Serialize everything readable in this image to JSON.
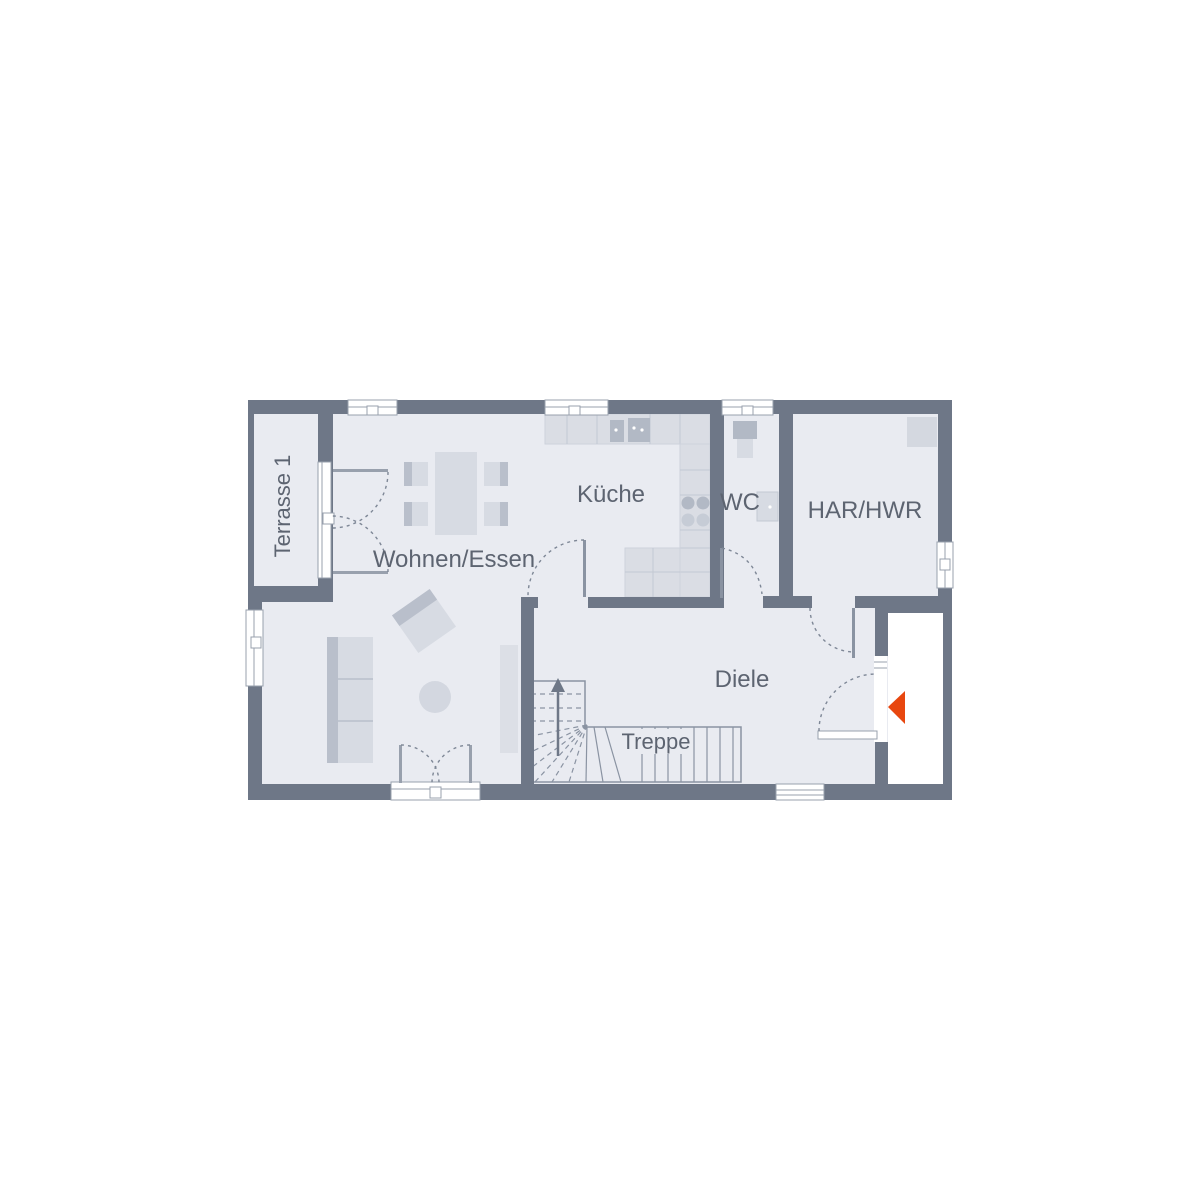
{
  "page": {
    "background": "#ffffff"
  },
  "floor_plan": {
    "rooms": [
      {
        "id": "terrace",
        "label": "Terrasse 1"
      },
      {
        "id": "living_dining",
        "label": "Wohnen/Essen"
      },
      {
        "id": "kitchen",
        "label": "Küche"
      },
      {
        "id": "wc",
        "label": "WC"
      },
      {
        "id": "utility",
        "label": "HAR/HWR"
      },
      {
        "id": "hallway",
        "label": "Diele"
      },
      {
        "id": "stairs",
        "label": "Treppe"
      }
    ],
    "colors": {
      "wall": "#6e7787",
      "floor": "#e9ebf1",
      "furniture_light": "#d7dbe3",
      "furniture_dark": "#b9bfcb",
      "counter": "#dadde4",
      "counter_line": "#c3c9d3",
      "appliance_dark": "#b2b9c5",
      "outline": "#8a93a2",
      "door_arc": "#7e8796",
      "label_text": "#5d6471",
      "entrance_arrow": "#e8470f",
      "window_white": "#ffffff"
    },
    "entrance_marker": {
      "shape": "triangle-left",
      "color": "#e8470f"
    }
  }
}
